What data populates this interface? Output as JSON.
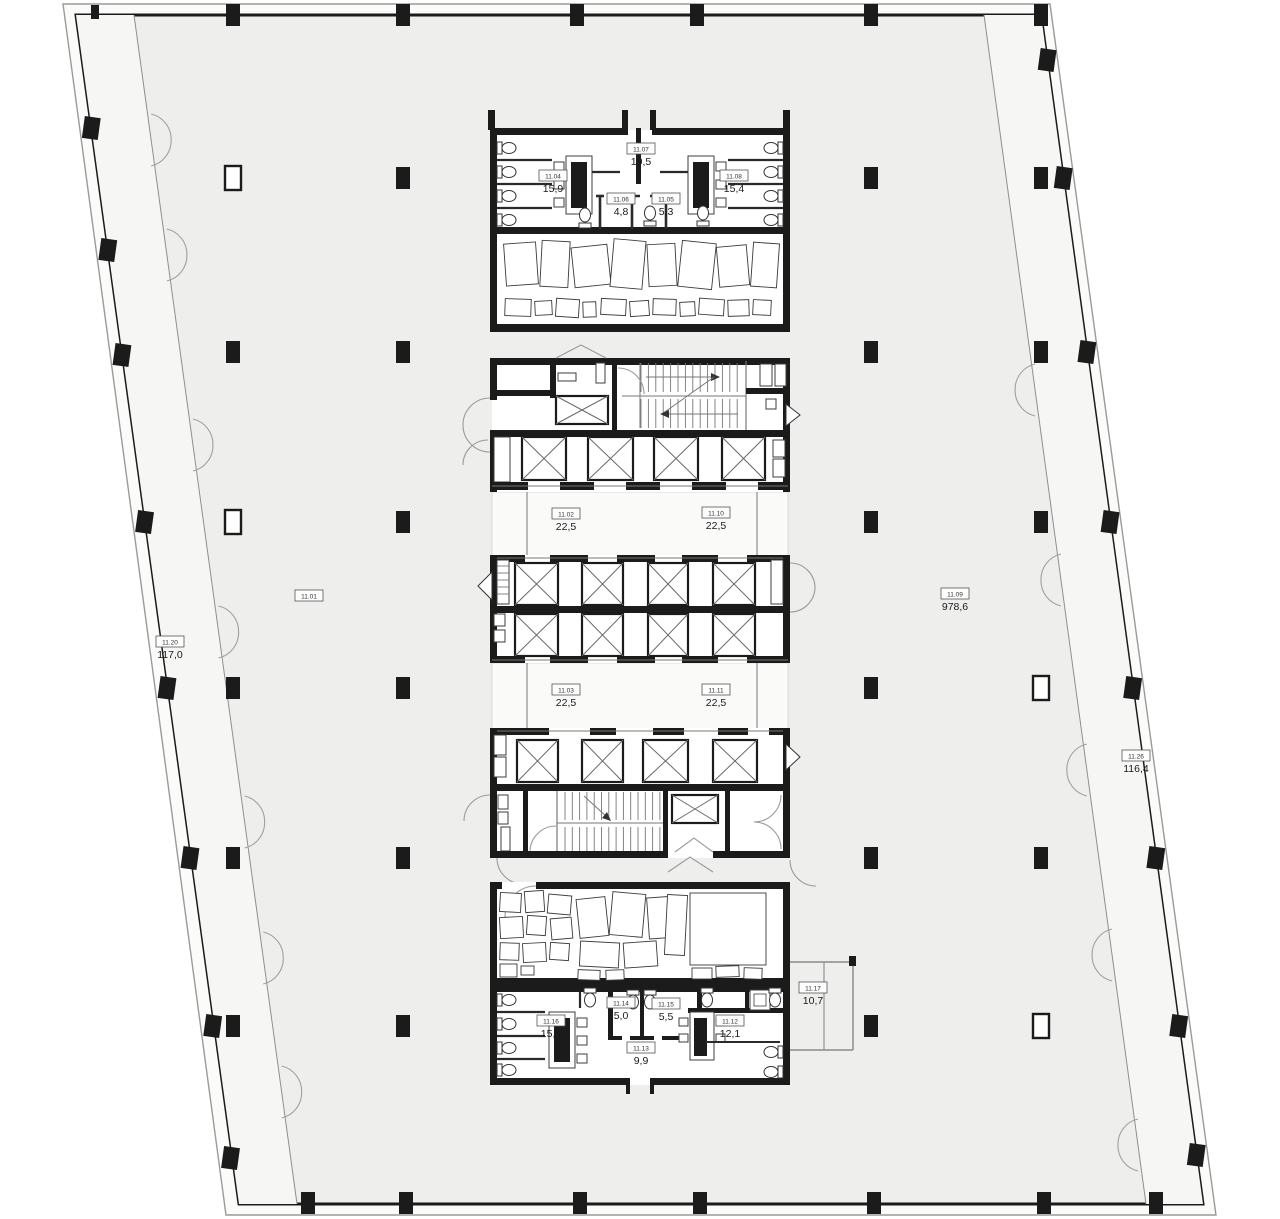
{
  "plan": {
    "title": "office-floor-plan",
    "unit_labels": [
      {
        "id": "11.04",
        "area": "15,9"
      },
      {
        "id": "11.07",
        "area": "10,5"
      },
      {
        "id": "11.08",
        "area": "15,4"
      },
      {
        "id": "11.06",
        "area": "4,8"
      },
      {
        "id": "11.05",
        "area": "5,3"
      },
      {
        "id": "11.02",
        "area": "22,5"
      },
      {
        "id": "11.10",
        "area": "22,5"
      },
      {
        "id": "11.01",
        "area": ""
      },
      {
        "id": "11.09",
        "area": "978,6"
      },
      {
        "id": "11.20",
        "area": "117,0"
      },
      {
        "id": "11.03",
        "area": "22,5"
      },
      {
        "id": "11.11",
        "area": "22,5"
      },
      {
        "id": "11.26",
        "area": "116,4"
      },
      {
        "id": "11.17",
        "area": "10,7"
      },
      {
        "id": "11.14",
        "area": "5,0"
      },
      {
        "id": "11.15",
        "area": "5,5"
      },
      {
        "id": "11.16",
        "area": "15,9"
      },
      {
        "id": "11.12",
        "area": "12,1"
      },
      {
        "id": "11.13",
        "area": "9,9"
      }
    ],
    "colors": {
      "wall": "#1b1b1b",
      "floor": "#eeeeed",
      "facade_strip": "#f6f6f5",
      "room_fill": "#ffffff",
      "thin_line": "#8f8f8f",
      "label_text": "#1a1a1a"
    }
  }
}
